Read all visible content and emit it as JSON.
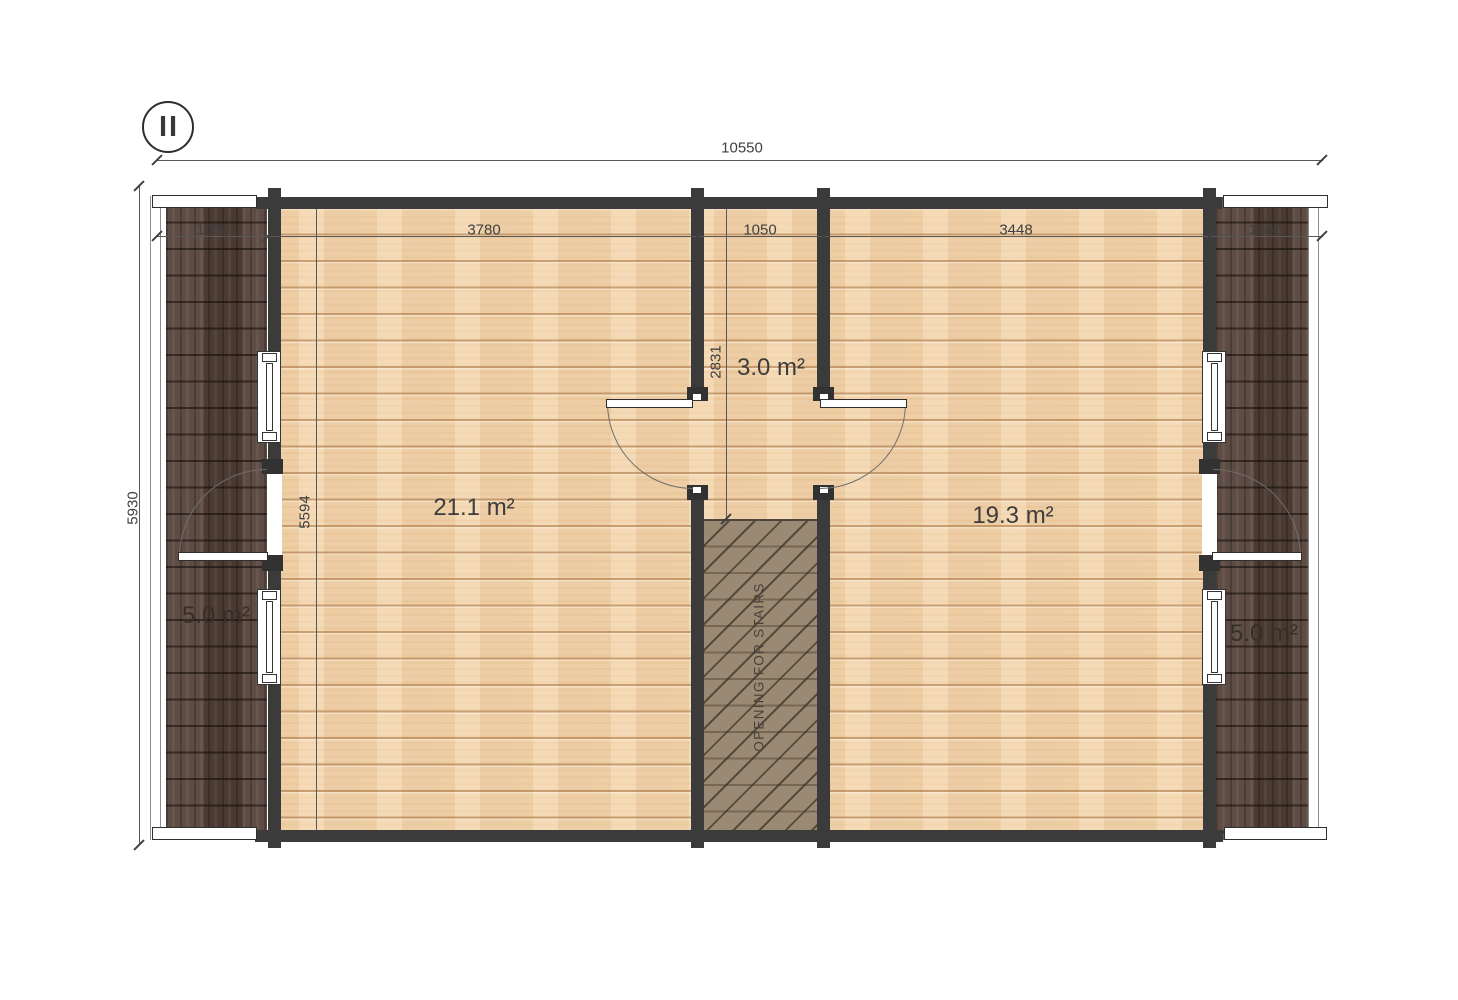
{
  "plan": {
    "floor_label": "II",
    "stairs_label": "OPENING FOR STAIRS",
    "rooms": {
      "left_room": {
        "area": "21.1 m²"
      },
      "right_room": {
        "area": "19.3 m²"
      },
      "hallway": {
        "area": "3.0 m²"
      },
      "left_balcony": {
        "area": "5.0 m²"
      },
      "right_balcony": {
        "area": "5.0 m²"
      }
    },
    "dimensions": {
      "overall_width": "10550",
      "overall_depth": "5930",
      "interior_depth": "5594",
      "hallway_depth": "2831",
      "width_segments": [
        "1000",
        "3780",
        "1050",
        "3448",
        "1000"
      ]
    },
    "colors": {
      "wall": "#3b3b3b",
      "floor_wood": "#f2d6b0",
      "balcony_wood": "#55433a",
      "stairs_hatch": "#9a8a74",
      "dimension_text": "#3f3f3f"
    }
  }
}
